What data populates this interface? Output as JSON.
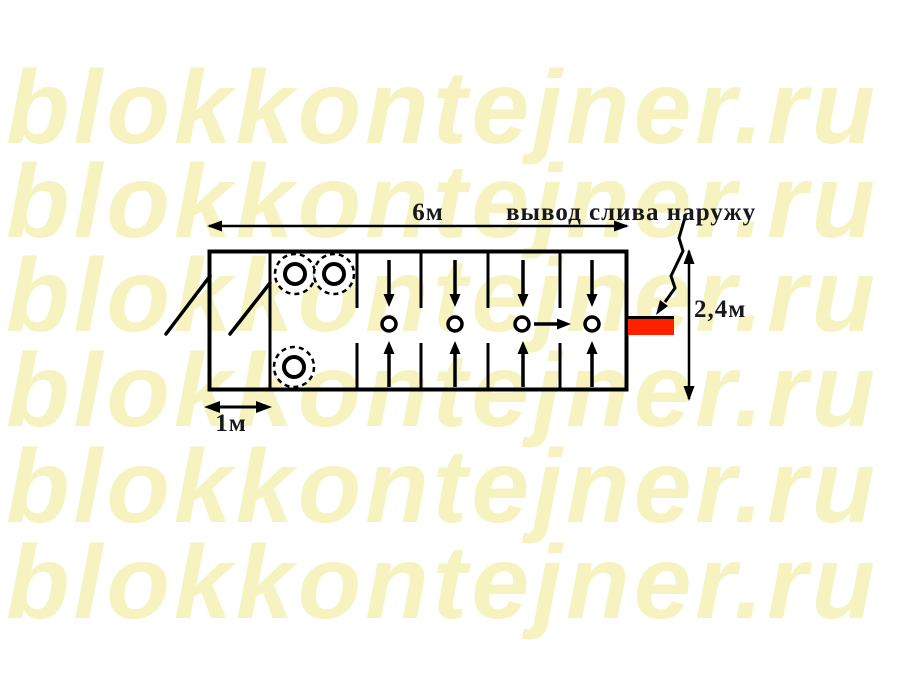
{
  "watermark": {
    "text": "blokkontejner.ru",
    "color": "#f6f3c0",
    "rows": 6
  },
  "diagram": {
    "type": "floor-plan",
    "drain_note": "вывод слива наружу",
    "dimensions": {
      "length": "6м",
      "height": "2,4м",
      "entry_width": "1м"
    },
    "colors": {
      "lines": "#000000",
      "drain_outlet": "#ff2000",
      "labels": "#17171c",
      "watermark": "#f6f3c0"
    },
    "symbols": {
      "shower_stalls": 4,
      "sinks": 3,
      "door_swings": 2,
      "drain_outlets": 1
    }
  }
}
